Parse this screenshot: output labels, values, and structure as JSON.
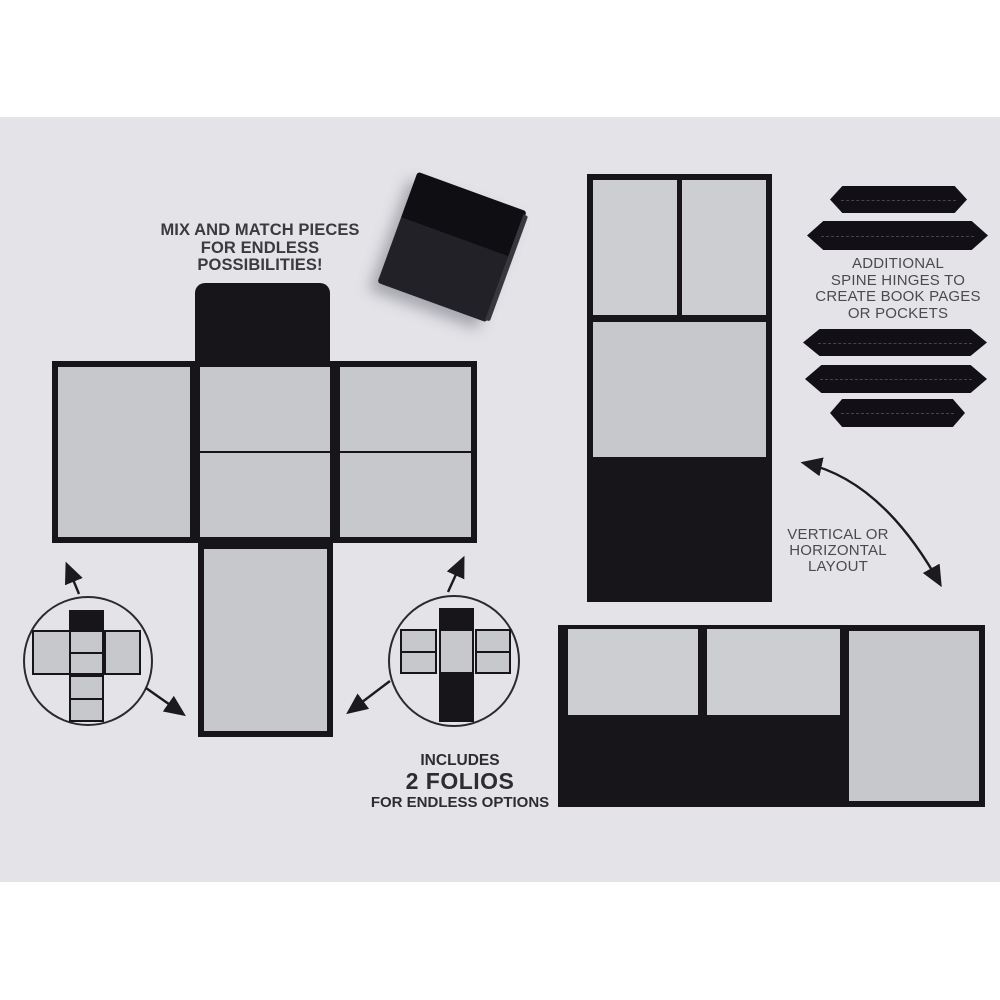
{
  "texts": {
    "mix_match": [
      "MIX AND MATCH PIECES",
      "FOR ENDLESS POSSIBILITIES!"
    ],
    "spine_hinges": [
      "ADDITIONAL",
      "SPINE HINGES TO",
      "CREATE BOOK PAGES",
      "OR POCKETS"
    ],
    "orientation": [
      "VERTICAL OR",
      "HORIZONTAL",
      "LAYOUT"
    ],
    "includes": [
      "INCLUDES",
      "2 FOLIOS",
      "FOR ENDLESS OPTIONS"
    ]
  },
  "colors": {
    "page_bg": "#ffffff",
    "card_bg": "#e4e4e8",
    "panel_black": "#17151a",
    "panel_gray": "#c7c8cb",
    "panel_gray_light": "#cdced2",
    "hinge_black": "#121016",
    "box_flap": "#0f0e12",
    "box_body": "#232128",
    "arrow_black": "#1c1a1e",
    "text_dark": "#3b3b3d",
    "text_mid": "#4b4b4d",
    "text_includes": "#2d2d2f"
  },
  "counts": {
    "spine_hinges_shown": 5,
    "folios_included": 2
  }
}
